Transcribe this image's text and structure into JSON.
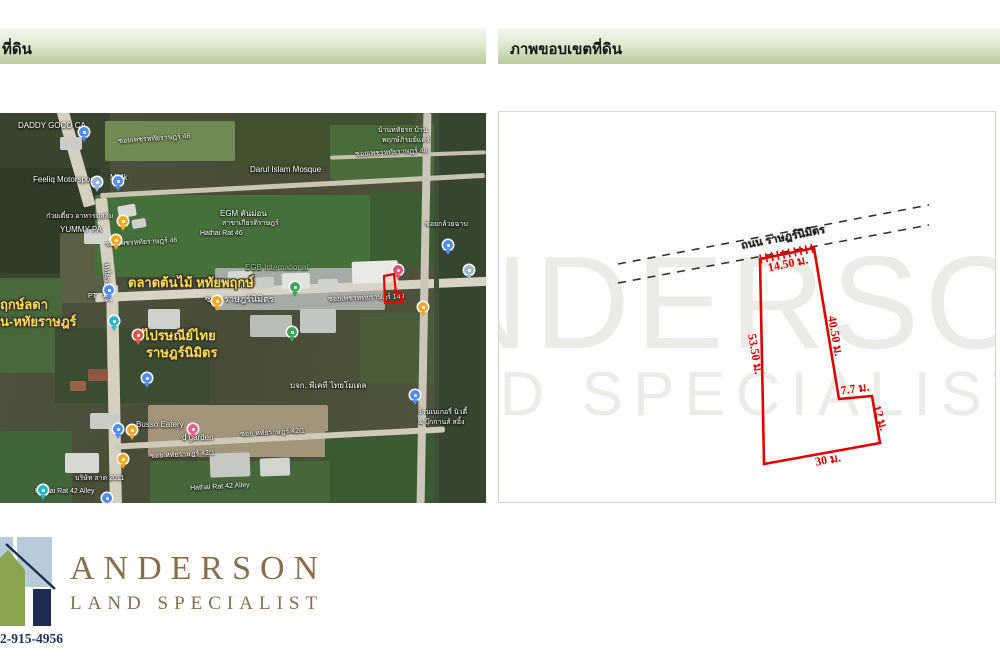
{
  "headers": {
    "left_label": "ที่ดิน",
    "right_label": "ภาพขอบเขตที่ดิน"
  },
  "colors": {
    "header_gradient_top": "#f4f7ef",
    "header_gradient_bottom": "#b8cb9d",
    "plot_red": "#e80000",
    "dashed_road": "#333333",
    "watermark": "#edebe7",
    "brand_brown": "#8a6e4a",
    "brand_navy": "#22315e",
    "logo_green": "#8ba54f",
    "logo_blue": "#b7cbd9",
    "logo_navy": "#1f2d52"
  },
  "map": {
    "patches": [
      {
        "x": 0,
        "y": 0,
        "w": 110,
        "h": 165,
        "c": "#39452e"
      },
      {
        "x": 105,
        "y": 8,
        "w": 130,
        "h": 40,
        "c": "#6f8a52"
      },
      {
        "x": 235,
        "y": 0,
        "w": 180,
        "h": 55,
        "c": "#41502f"
      },
      {
        "x": 330,
        "y": 12,
        "w": 156,
        "h": 55,
        "c": "#4a6b3a"
      },
      {
        "x": 0,
        "y": 55,
        "w": 100,
        "h": 105,
        "c": "#2f3c27"
      },
      {
        "x": 60,
        "y": 120,
        "w": 45,
        "h": 70,
        "c": "#5a5f46"
      },
      {
        "x": 95,
        "y": 82,
        "w": 275,
        "h": 82,
        "c": "#46703a"
      },
      {
        "x": 370,
        "y": 78,
        "w": 116,
        "h": 75,
        "c": "#3c5c32"
      },
      {
        "x": 0,
        "y": 165,
        "w": 62,
        "h": 95,
        "c": "#49683c"
      },
      {
        "x": 215,
        "y": 155,
        "w": 170,
        "h": 42,
        "c": "#a7aba6"
      },
      {
        "x": 55,
        "y": 215,
        "w": 155,
        "h": 75,
        "c": "#3c4c32"
      },
      {
        "x": 360,
        "y": 200,
        "w": 80,
        "h": 70,
        "c": "#4a5d3b"
      },
      {
        "x": 148,
        "y": 292,
        "w": 180,
        "h": 52,
        "c": "#a3957a"
      },
      {
        "x": 325,
        "y": 318,
        "w": 161,
        "h": 72,
        "c": "#3c5a31"
      },
      {
        "x": 0,
        "y": 318,
        "w": 72,
        "h": 72,
        "c": "#42643a"
      },
      {
        "x": 150,
        "y": 348,
        "w": 180,
        "h": 42,
        "c": "#45673a"
      },
      {
        "x": 438,
        "y": 0,
        "w": 48,
        "h": 390,
        "c": "#36452e"
      }
    ],
    "roads": [
      {
        "x": 70,
        "y": -5,
        "w": 12,
        "h": 100,
        "rot": -16,
        "c": "#d6d0c0"
      },
      {
        "x": 100,
        "y": 85,
        "w": 12,
        "h": 95,
        "rot": -6,
        "c": "#d6d0c0"
      },
      {
        "x": 108,
        "y": 172,
        "w": 12,
        "h": 222,
        "rot": -1,
        "c": "#d6d0c0"
      },
      {
        "x": 95,
        "y": 172,
        "w": 394,
        "h": 9,
        "rot": -2.4,
        "c": "#d8d3c4"
      },
      {
        "x": 420,
        "y": 0,
        "w": 8,
        "h": 392,
        "rot": 1,
        "c": "#cbc7b8"
      },
      {
        "x": 434,
        "y": 0,
        "w": 5,
        "h": 392,
        "rot": 0,
        "c": "#3f4f3a"
      },
      {
        "x": 115,
        "y": 322,
        "w": 330,
        "h": 6,
        "rot": -3,
        "c": "#cfcaba"
      },
      {
        "x": 100,
        "y": 70,
        "w": 385,
        "h": 5,
        "rot": -3,
        "c": "#c9c4b4"
      },
      {
        "x": 330,
        "y": 40,
        "w": 156,
        "h": 4,
        "rot": -2,
        "c": "#c5c0b0"
      }
    ],
    "buildings": [
      {
        "x": 228,
        "y": 158,
        "w": 24,
        "h": 14,
        "c": "#d7d9d5",
        "rot": -2
      },
      {
        "x": 256,
        "y": 164,
        "w": 18,
        "h": 11,
        "c": "#c8ccc8",
        "rot": -2
      },
      {
        "x": 282,
        "y": 160,
        "w": 28,
        "h": 16,
        "c": "#e2e3df",
        "rot": -2
      },
      {
        "x": 318,
        "y": 166,
        "w": 20,
        "h": 12,
        "c": "#cfd3cf",
        "rot": -2
      },
      {
        "x": 352,
        "y": 148,
        "w": 46,
        "h": 22,
        "c": "#e9eae6",
        "rot": -2
      },
      {
        "x": 300,
        "y": 196,
        "w": 36,
        "h": 24,
        "c": "#c2c6c0",
        "rot": 0
      },
      {
        "x": 250,
        "y": 202,
        "w": 42,
        "h": 22,
        "c": "#b9bdb8",
        "rot": 0
      },
      {
        "x": 148,
        "y": 196,
        "w": 32,
        "h": 20,
        "c": "#cfd2cd",
        "rot": 0
      },
      {
        "x": 118,
        "y": 92,
        "w": 18,
        "h": 12,
        "c": "#d8d9d5",
        "rot": -10
      },
      {
        "x": 132,
        "y": 106,
        "w": 14,
        "h": 9,
        "c": "#cdd0cb",
        "rot": -10
      },
      {
        "x": 84,
        "y": 116,
        "w": 26,
        "h": 15,
        "c": "#d3d4d0",
        "rot": 0
      },
      {
        "x": 60,
        "y": 24,
        "w": 22,
        "h": 13,
        "c": "#c9ccc8",
        "rot": 0
      },
      {
        "x": 88,
        "y": 256,
        "w": 20,
        "h": 12,
        "c": "#8d5a3f",
        "rot": 0
      },
      {
        "x": 70,
        "y": 268,
        "w": 16,
        "h": 10,
        "c": "#9a6247",
        "rot": 0
      },
      {
        "x": 210,
        "y": 340,
        "w": 40,
        "h": 24,
        "c": "#c6c9c3",
        "rot": -2
      },
      {
        "x": 260,
        "y": 345,
        "w": 30,
        "h": 18,
        "c": "#d2d5cf",
        "rot": -2
      },
      {
        "x": 90,
        "y": 300,
        "w": 28,
        "h": 16,
        "c": "#c9ccc6",
        "rot": 0
      },
      {
        "x": 65,
        "y": 340,
        "w": 34,
        "h": 20,
        "c": "#d6d8d2",
        "rot": 0
      }
    ],
    "labels": [
      {
        "t": "DADDY GOOD CA",
        "x": 18,
        "y": 8,
        "c": "w",
        "s": 8
      },
      {
        "t": "บ้านหทัยรถ บ้าน",
        "x": 378,
        "y": 14,
        "c": "w",
        "s": 7
      },
      {
        "t": "พฤกษ์ภิรมย์แคร์",
        "x": 382,
        "y": 24,
        "c": "w",
        "s": 7
      },
      {
        "t": "Feeliq Motorsport",
        "x": 33,
        "y": 62,
        "c": "w",
        "s": 8
      },
      {
        "t": "MMk",
        "x": 110,
        "y": 60,
        "c": "w",
        "s": 8
      },
      {
        "t": "ซอยเพชรหทัยราษฎร์ 46",
        "x": 118,
        "y": 25,
        "c": "w",
        "s": 7,
        "r": -4
      },
      {
        "t": "ซอยเพชรหทัยราษฎร์ 48",
        "x": 355,
        "y": 38,
        "c": "w",
        "s": 7,
        "r": -3
      },
      {
        "t": "Darul Islam Mosque",
        "x": 250,
        "y": 52,
        "c": "w",
        "s": 8
      },
      {
        "t": "ก๋วยเตี๋ยว อาหารมุสลิม",
        "x": 46,
        "y": 100,
        "c": "w",
        "s": 7
      },
      {
        "t": "YUMMY PA",
        "x": 60,
        "y": 112,
        "c": "w",
        "s": 8
      },
      {
        "t": "EGM คันม่อน",
        "x": 220,
        "y": 96,
        "c": "w",
        "s": 8
      },
      {
        "t": "สาขาเกียรติราษฎร์",
        "x": 222,
        "y": 107,
        "c": "w",
        "s": 7
      },
      {
        "t": "Hathai Rat 46",
        "x": 200,
        "y": 117,
        "c": "w",
        "s": 7
      },
      {
        "t": "ซอยเพชรหทัยราษฎร์ 46",
        "x": 105,
        "y": 128,
        "c": "w",
        "s": 7,
        "r": -3
      },
      {
        "t": "ซอยกล้วยฉาบ",
        "x": 425,
        "y": 108,
        "c": "w",
        "s": 7
      },
      {
        "t": "หทัยราษฎร์",
        "x": 112,
        "y": 150,
        "c": "w",
        "s": 8,
        "r": 90
      },
      {
        "t": "EGB International",
        "x": 245,
        "y": 150,
        "c": "g",
        "s": 8
      },
      {
        "t": "ตลาดต้นไม้  หทัยพฤกษ์",
        "x": 128,
        "y": 163,
        "c": "y",
        "s": 13
      },
      {
        "t": "ซอย ราษฎร์นิมิตร",
        "x": 205,
        "y": 181,
        "c": "w",
        "s": 9
      },
      {
        "t": "ซอยเพชรหทัยราษฎร์ 149",
        "x": 328,
        "y": 183,
        "c": "w",
        "s": 7,
        "r": -2
      },
      {
        "t": "ฤกษ์ลดา",
        "x": 0,
        "y": 185,
        "c": "y",
        "s": 13
      },
      {
        "t": "น-หทัยราษฎร์",
        "x": 0,
        "y": 202,
        "c": "y",
        "s": 13
      },
      {
        "t": "PT",
        "x": 88,
        "y": 180,
        "c": "w",
        "s": 7
      },
      {
        "t": "ไปรษณีย์ไทย",
        "x": 143,
        "y": 216,
        "c": "y",
        "s": 13
      },
      {
        "t": "ราษฎร์นิมิตร",
        "x": 146,
        "y": 233,
        "c": "y",
        "s": 13
      },
      {
        "t": "บจก. พีเคที ไทยโมเดล",
        "x": 290,
        "y": 268,
        "c": "w",
        "s": 8
      },
      {
        "t": "ร้านเบเกอรี่ นิวตี้",
        "x": 418,
        "y": 296,
        "c": "w",
        "s": 7
      },
      {
        "t": "& บุ๊กกานส์ สอิ้ง",
        "x": 418,
        "y": 306,
        "c": "w",
        "s": 7
      },
      {
        "t": "Busso Eatery",
        "x": 136,
        "y": 307,
        "c": "w",
        "s": 8
      },
      {
        "t": "d garden",
        "x": 182,
        "y": 320,
        "c": "w",
        "s": 8
      },
      {
        "t": "ซอย หทัยราษฎร์ 42/1",
        "x": 240,
        "y": 318,
        "c": "w",
        "s": 7,
        "r": -3
      },
      {
        "t": "ซอย หทัยราษฎร์ 42/1",
        "x": 150,
        "y": 340,
        "c": "w",
        "s": 7,
        "r": -3
      },
      {
        "t": "บริษัท ลาด 2011",
        "x": 75,
        "y": 362,
        "c": "w",
        "s": 7
      },
      {
        "t": "Hathai Rat 42 Alley",
        "x": 35,
        "y": 375,
        "c": "w",
        "s": 7
      },
      {
        "t": "Hathai Rat 42 Alley",
        "x": 190,
        "y": 372,
        "c": "w",
        "s": 7,
        "r": -3
      }
    ],
    "pins": [
      {
        "x": 79,
        "y": 14,
        "c": "#4e8df5"
      },
      {
        "x": 92,
        "y": 64,
        "c": "#8fb3d9"
      },
      {
        "x": 113,
        "y": 63,
        "c": "#4e8df5"
      },
      {
        "x": 118,
        "y": 103,
        "c": "#f5a623"
      },
      {
        "x": 111,
        "y": 122,
        "c": "#f5a623"
      },
      {
        "x": 104,
        "y": 172,
        "c": "#4e8df5"
      },
      {
        "x": 109,
        "y": 203,
        "c": "#28b8c8"
      },
      {
        "x": 133,
        "y": 217,
        "c": "#e0524d"
      },
      {
        "x": 212,
        "y": 183,
        "c": "#f5a623"
      },
      {
        "x": 290,
        "y": 169,
        "c": "#3aa757"
      },
      {
        "x": 287,
        "y": 214,
        "c": "#3aa757"
      },
      {
        "x": 142,
        "y": 260,
        "c": "#4e8df5"
      },
      {
        "x": 113,
        "y": 311,
        "c": "#4e8df5"
      },
      {
        "x": 127,
        "y": 312,
        "c": "#f5a623"
      },
      {
        "x": 188,
        "y": 311,
        "c": "#e85d8a"
      },
      {
        "x": 118,
        "y": 341,
        "c": "#f5a623"
      },
      {
        "x": 38,
        "y": 372,
        "c": "#28b8c8"
      },
      {
        "x": 102,
        "y": 380,
        "c": "#4e8df5"
      },
      {
        "x": 393,
        "y": 152,
        "c": "#e8506e"
      },
      {
        "x": 418,
        "y": 189,
        "c": "#f0a830"
      },
      {
        "x": 443,
        "y": 127,
        "c": "#4e8df5"
      },
      {
        "x": 464,
        "y": 152,
        "c": "#9fb8cc"
      },
      {
        "x": 410,
        "y": 277,
        "c": "#4e8df5"
      }
    ],
    "marker_points": "384,163 394,161 396,181 401,180 402,189 385,190"
  },
  "diagram": {
    "road_label": "ถนน ราษฎร์นิมิตร",
    "watermark_line1": "ANDERSON",
    "watermark_line2": "LAND SPECIALIST",
    "dashed_lines": [
      [
        119,
        152,
        430,
        93
      ],
      [
        119,
        171,
        430,
        113
      ]
    ],
    "polygon": [
      [
        261,
        147
      ],
      [
        315,
        136
      ],
      [
        340,
        287
      ],
      [
        373,
        284
      ],
      [
        381,
        331
      ],
      [
        265,
        352
      ]
    ],
    "dimensions": [
      {
        "label": "14.50 ม.",
        "x": 289,
        "y": 152,
        "rot": -12
      },
      {
        "label": "40.50 ม.",
        "x": 336,
        "y": 224,
        "rot": 80
      },
      {
        "label": "53.50 ม.",
        "x": 256,
        "y": 242,
        "rot": 80
      },
      {
        "label": "7.7 ม.",
        "x": 356,
        "y": 277,
        "rot": -8
      },
      {
        "label": "12 ม.",
        "x": 381,
        "y": 306,
        "rot": 72
      },
      {
        "label": "30 ม.",
        "x": 329,
        "y": 348,
        "rot": -10
      }
    ]
  },
  "footer": {
    "brand_name": "ANDERSON",
    "brand_tagline": "LAND SPECIALIST",
    "phone": "2-915-4956"
  }
}
